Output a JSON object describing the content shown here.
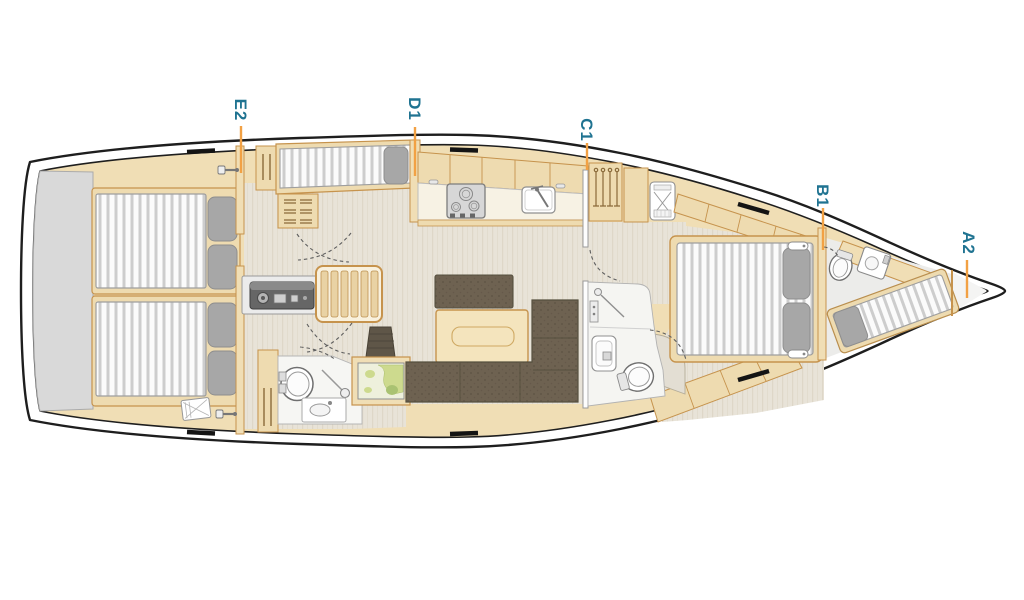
{
  "figure": {
    "type": "yacht-interior-deck-plan",
    "orientation": "bow-right-stern-left"
  },
  "labels": [
    {
      "id": "E2",
      "points_to": "aft-cabins-companionway-zone"
    },
    {
      "id": "D1",
      "points_to": "utility-cabin-berth-zone"
    },
    {
      "id": "C1",
      "points_to": "salon-forward-bulkhead"
    },
    {
      "id": "B1",
      "points_to": "forward-cabin-bulkhead"
    },
    {
      "id": "A2",
      "points_to": "bow-anchor-locker-zone"
    }
  ],
  "colors": {
    "label_text": "#1f7391",
    "leader_line": "#f2a144",
    "hull_outline": "#1e1e1e",
    "wood_fill": "#f0deb5",
    "wood_stroke": "#c6934d",
    "floor": "#e8e3d8",
    "upholstery": "#6e6251",
    "mattress": "#fbfbfb",
    "mattress_stripe": "#cdcdcd",
    "pillow": "#a7a7a7",
    "swim_platform": "#d9d9d9"
  },
  "fixtures": [
    "swim-platform",
    "aft-double-berth-port",
    "aft-double-berth-starboard",
    "engine-box",
    "companionway-steps",
    "utility-single-berth",
    "galley-stove",
    "galley-sink",
    "aft-head-toilet",
    "aft-head-shower",
    "aft-head-washbasin",
    "nav-chart-table",
    "salon-table",
    "salon-sofa",
    "salon-bench",
    "stool",
    "hanging-locker",
    "vanity-chair",
    "forward-island-berth",
    "forward-head-toilet",
    "forward-head-shower",
    "forward-head-washbasin",
    "bow-toilet",
    "bow-washbasin",
    "bow-crew-berth",
    "anchor-locker"
  ]
}
